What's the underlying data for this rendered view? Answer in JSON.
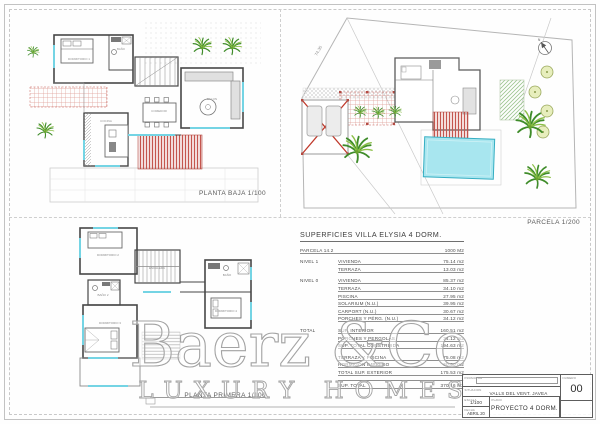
{
  "colors": {
    "wall": "#474747",
    "window_cyan": "#74d4e4",
    "pergola_red": "#c4564e",
    "pool_cyan": "#a8e6ef",
    "palm_green": "#3f8c2a",
    "watermark_gray": "#a3a3a3"
  },
  "plans": {
    "planta_baja": {
      "label": "PLANTA BAJA 1/100",
      "rooms": {
        "dorm1": "DORMITORIO 1",
        "bano": "BAÑO",
        "salon": "SALON",
        "comedor": "COMEDOR",
        "cocina": "COCINA"
      }
    },
    "planta_primera": {
      "label": "PLANTA PRIMERA 1/100",
      "rooms": {
        "dorm2": "DORMITORIO 2",
        "escalera": "ESCALERA",
        "bano2": "BAÑO 2",
        "dorm3": "DORMITORIO 3",
        "bano": "BAÑO",
        "dorm4": "DORMITORIO 4"
      }
    },
    "parcela": {
      "label": "PARCELA 1/200",
      "dimension": "74.35",
      "compass": "N"
    }
  },
  "table": {
    "title": "SUPERFICIES VILLA ELYSIA 4 DORM.",
    "sections": [
      {
        "rows": [
          {
            "s": "PARCELA 14.2",
            "l": "",
            "v": "1000 M2"
          }
        ]
      },
      {
        "rows": [
          {
            "s": "NIVEL 1",
            "l": "VIVIENDA",
            "v": "75.14 m2"
          },
          {
            "s": "",
            "l": "TERRAZA",
            "v": "13.03 m2"
          }
        ]
      },
      {
        "rows": [
          {
            "s": "NIVEL 0",
            "l": "VIVIENDA",
            "v": "85.37 m2"
          },
          {
            "s": "",
            "l": "TERRAZA",
            "v": "34.10 m2"
          },
          {
            "s": "",
            "l": "PISCINA",
            "v": "27.95 m2"
          },
          {
            "s": "",
            "l": "SOLARIUM (N.U.)",
            "v": "39.95 m2"
          },
          {
            "s": "",
            "l": "CARPORT (N.U.)",
            "v": "30.67 m2"
          },
          {
            "s": "",
            "l": "PORCHES Y PÉRG. (N.U.)",
            "v": "34.12 m2"
          }
        ]
      },
      {
        "rows": [
          {
            "s": "TOTAL",
            "l": "SUP. INTERIOR",
            "v": "160.51 m2"
          },
          {
            "s": "",
            "l": "PORCHES Y PERGOLAS",
            "v": "34.12 m2"
          },
          {
            "s": "",
            "l": "SUP. TOTAL CONSTRUIDA",
            "v": "194.63 m2"
          }
        ]
      },
      {
        "rows": [
          {
            "s": "",
            "l": "TERRAZA Y PISCINA",
            "v": "75.08 m2"
          },
          {
            "s": "",
            "l": "HORMIGON IMPRESO",
            "v": "60.50 m2"
          },
          {
            "s": "",
            "l": "TOTAL SUP. EXTERIOR",
            "v": "175.53 m2"
          }
        ]
      },
      {
        "rows": [
          {
            "s": "",
            "l": "SUP. TOTAL",
            "v": "370.16 M2"
          }
        ]
      }
    ]
  },
  "watermark": {
    "brand": "Baerz &Co",
    "tagline": "LUXURY HOMES"
  },
  "titleblock": {
    "promotor_label": "PROMOTOR",
    "situacion_label": "SITUACION",
    "situacion_value": "VALLS DEL VENT. JAVEA",
    "escala_label": "ESCALA",
    "escala_value": "1/100",
    "fecha_label": "FECHA",
    "fecha_value": "ABRIL 20",
    "plano_label": "PLANO",
    "plano_value": "PROYECTO 4 DORM.",
    "numero_label": "NUMERO",
    "numero_value": "00"
  }
}
